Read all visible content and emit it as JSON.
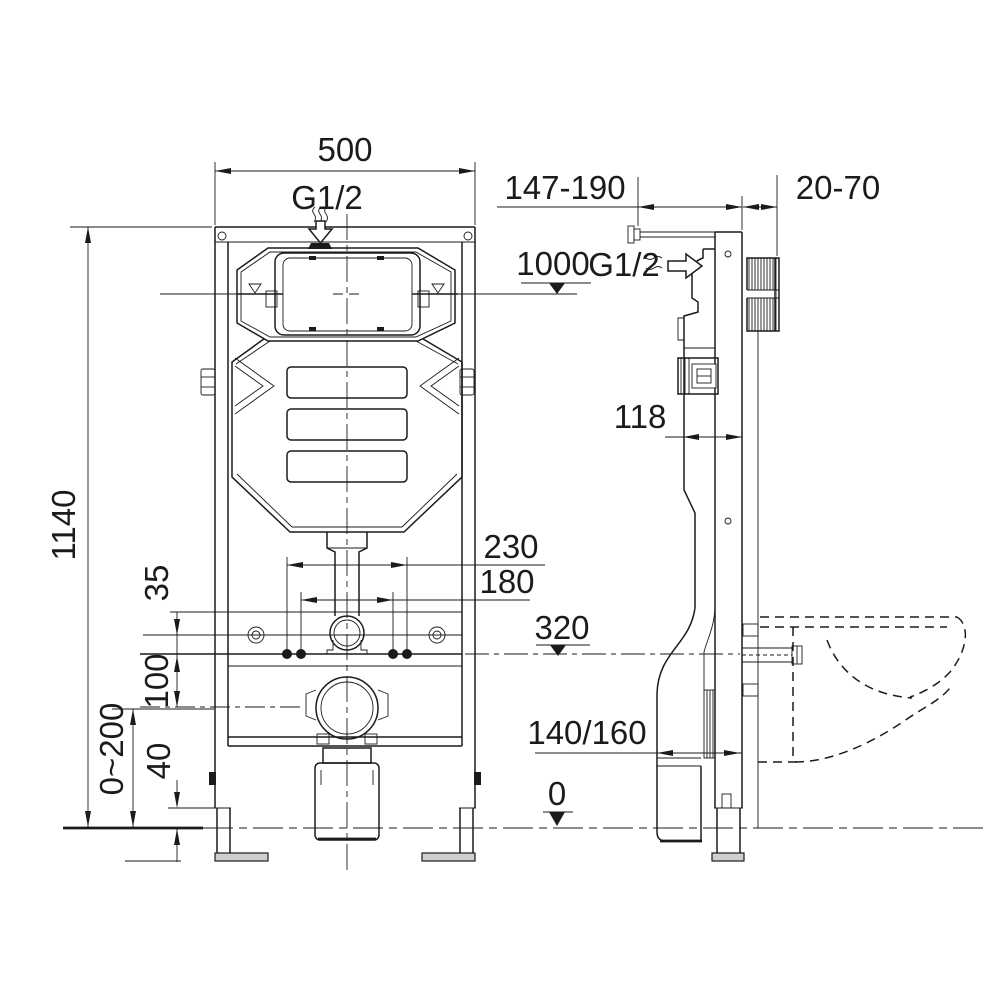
{
  "drawing": {
    "background": "#ffffff",
    "line_color": "#1b1b1b",
    "labels": {
      "width_top": "500",
      "inlet_front": "G1/2",
      "rod_range": "147-190",
      "wall_range": "20-70",
      "water_level": "1000",
      "inlet_side": "G1/2",
      "depth": "118",
      "height": "1140",
      "spacing_outer": "230",
      "spacing_inner": "180",
      "fixing_height": "320",
      "offset_35": "35",
      "offset_100": "100",
      "leg_adjust": "0~200",
      "offset_40": "40",
      "outlet_size": "140/160",
      "floor_level": "0"
    }
  }
}
